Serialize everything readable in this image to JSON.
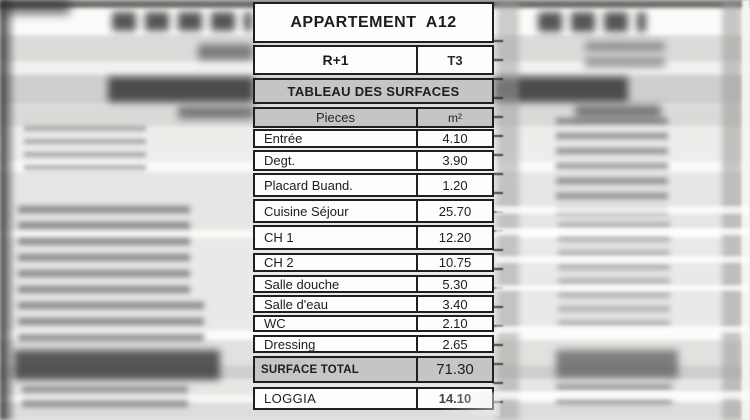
{
  "table": {
    "title": "APPARTEMENT  A12",
    "floor": "R+1",
    "unit_type": "T3",
    "section_header": "TABLEAU DES SURFACES",
    "columns": {
      "rooms": "Pieces",
      "area": "m²"
    },
    "rows": [
      {
        "label": "Entrée",
        "value": "4.10"
      },
      {
        "label": "Degt.",
        "value": "3.90"
      },
      {
        "label": "Placard Buand.",
        "value": "1.20"
      },
      {
        "label": "Cuisine Séjour",
        "value": "25.70"
      },
      {
        "label": "CH 1",
        "value": "12.20"
      },
      {
        "label": "CH 2",
        "value": "10.75"
      },
      {
        "label": "Salle douche",
        "value": "5.30"
      },
      {
        "label": "Salle d'eau",
        "value": "3.40"
      },
      {
        "label": "WC",
        "value": "2.10"
      },
      {
        "label": "Dressing",
        "value": "2.65"
      }
    ],
    "total": {
      "label": "SURFACE TOTAL",
      "value": "71.30"
    },
    "loggia": {
      "label": "LOGGIA",
      "value": "14.10"
    }
  },
  "colors": {
    "border": "#1f1f1f",
    "header_bg": "#c5c5c4",
    "text": "#1d1d1d",
    "paper": "#e9e8e6"
  }
}
